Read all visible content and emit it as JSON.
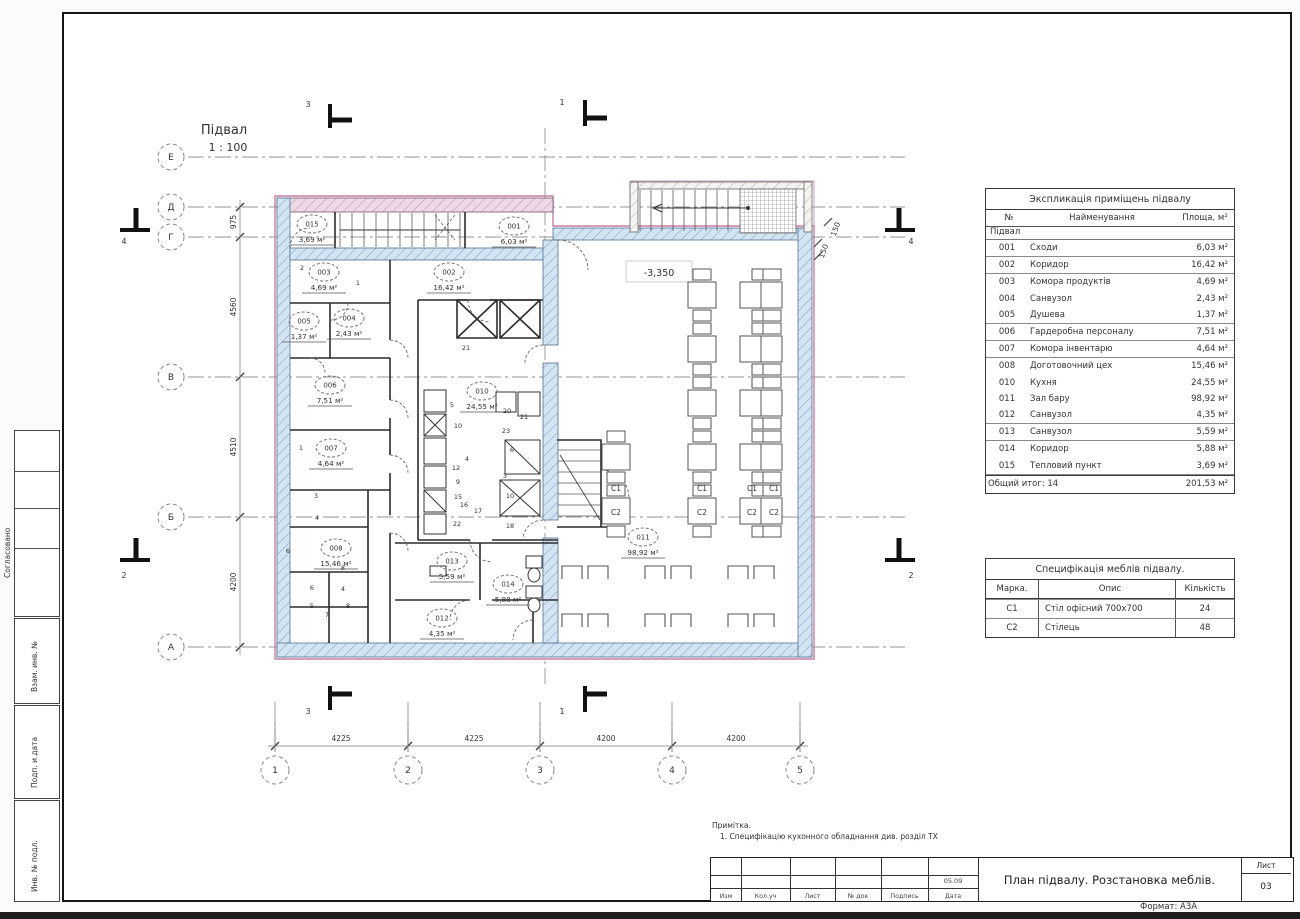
{
  "sheet": {
    "plan_title": "Підвал",
    "plan_scale": "1 : 100",
    "elevation": "-3,350",
    "note_title": "Примітка.",
    "note_line": "1.  Специфікацію кухонного обладнання див. розділ ТХ",
    "format_label": "Формат: А3А"
  },
  "axes": {
    "horizontal": [
      "Е",
      "Д",
      "Г",
      "В",
      "Б",
      "А"
    ],
    "vertical": [
      "1",
      "2",
      "3",
      "4",
      "5"
    ],
    "v_dims": [
      "975",
      "4560",
      "4510",
      "4200"
    ],
    "h_dims": [
      "4225",
      "4225",
      "4200",
      "4200"
    ],
    "wall_dim": "150",
    "section_top_left": "3",
    "section_top_right": "1",
    "section_side_upper": "4",
    "section_side_lower": "2"
  },
  "rooms": [
    {
      "number": "015",
      "area": "3,69 м²"
    },
    {
      "number": "001",
      "area": "6,03 м²"
    },
    {
      "number": "003",
      "area": "4,69 м²"
    },
    {
      "number": "002",
      "area": "16,42 м²"
    },
    {
      "number": "005",
      "area": "1,37 м²"
    },
    {
      "number": "004",
      "area": "2,43 м²"
    },
    {
      "number": "006",
      "area": "7,51 м²"
    },
    {
      "number": "010",
      "area": "24,55 м²"
    },
    {
      "number": "007",
      "area": "4,64 м²"
    },
    {
      "number": "008",
      "area": "15,46 м²"
    },
    {
      "number": "013",
      "area": "5,59 м²"
    },
    {
      "number": "014",
      "area": "5,88 м²"
    },
    {
      "number": "012",
      "area": "4,35 м²"
    },
    {
      "number": "011",
      "area": "98,92 м²"
    }
  ],
  "furniture_marks": {
    "table": "С1",
    "chair": "С2"
  },
  "equipment_tags": [
    "5",
    "10",
    "4",
    "12",
    "9",
    "15",
    "16",
    "17",
    "22",
    "18",
    "20",
    "21",
    "23",
    "6",
    "3",
    "10",
    "2",
    "1",
    "3",
    "4",
    "6",
    "8",
    "6",
    "4",
    "5",
    "7",
    "8",
    "21",
    "1"
  ],
  "explication_table": {
    "title": "Экспликація приміщень підвалу",
    "col_headers": [
      "№",
      "Найменування",
      "Площа, м²"
    ],
    "group_label": "Підвал",
    "rows": [
      [
        "001",
        "Сходи",
        "6,03 м²"
      ],
      [
        "002",
        "Коридор",
        "16,42 м²"
      ],
      [
        "003",
        "Комора продуктів",
        "4,69 м²"
      ],
      [
        "004",
        "Санвузол",
        "2,43 м²"
      ],
      [
        "005",
        "Душева",
        "1,37 м²"
      ],
      [
        "006",
        "Гардеробна персоналу",
        "7,51 м²"
      ],
      [
        "007",
        "Комора інвентарю",
        "4,64 м²"
      ],
      [
        "008",
        "Доготовочний цех",
        "15,46 м²"
      ],
      [
        "010",
        "Кухня",
        "24,55 м²"
      ],
      [
        "011",
        "Зал бару",
        "98,92 м²"
      ],
      [
        "012",
        "Санвузол",
        "4,35 м²"
      ],
      [
        "013",
        "Санвузол",
        "5,59 м²"
      ],
      [
        "014",
        "Коридор",
        "5,88 м²"
      ],
      [
        "015",
        "Тепловий пункт",
        "3,69 м²"
      ]
    ],
    "total_label": "Общий итог: 14",
    "total_area": "201,53 м²"
  },
  "furniture_table": {
    "title": "Специфікація меблів підвалу.",
    "col_headers": [
      "Марка.",
      "Опис",
      "Кількість"
    ],
    "rows": [
      [
        "С1",
        "Стіл офісний 700х700",
        "24"
      ],
      [
        "С2",
        "Стілець",
        "48"
      ]
    ]
  },
  "title_block": {
    "title": "План підвалу. Розстановка меблів.",
    "bottom_labels": [
      "Изм",
      "Кол.уч",
      "Лист",
      "№ док",
      "Подпись",
      "Дата"
    ],
    "date": "05.09",
    "sheet_label": "Лист",
    "sheet_number": "03"
  },
  "side_labels": [
    "Согласовано",
    "Взам. инв. №",
    "Подп. и дата",
    "Инв. № подл."
  ]
}
